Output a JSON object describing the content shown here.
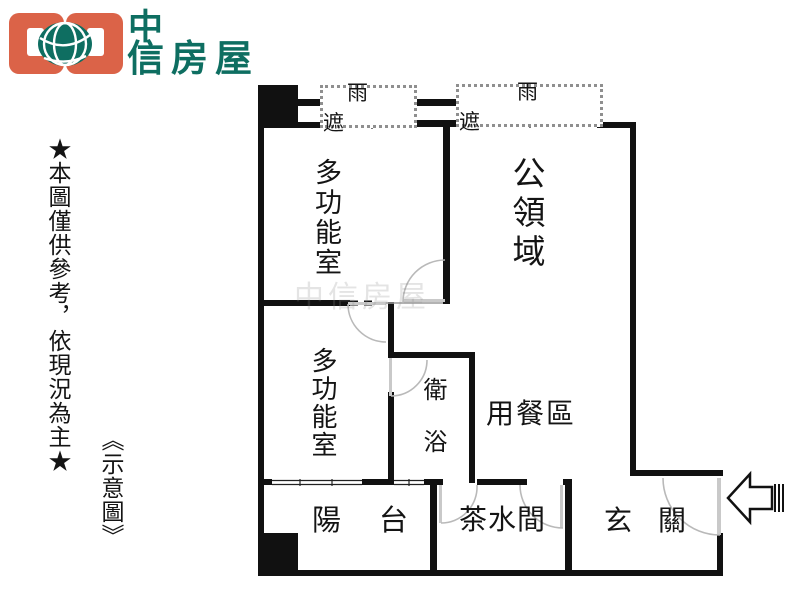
{
  "header": {
    "brand_char_top": "中",
    "brand_chars_bottom": "信房屋"
  },
  "side_notes": {
    "disclaimer": "★本圖僅供參考，依現況為主★",
    "caption": "《示意圖》"
  },
  "floorplan": {
    "labels": {
      "rain_shelter_1": "雨遮",
      "rain_shelter_2": "雨遮",
      "multi_function_room_1": "多功能室",
      "public_area": "公領域",
      "multi_function_room_2": "多功能室",
      "bathroom": "衛浴",
      "dining_area": "用餐區",
      "balcony": "陽台",
      "pantry": "茶水間",
      "entry": "玄關"
    },
    "watermark": "中信房屋",
    "colors": {
      "wall": "#111111",
      "door_line": "#b9b9b9",
      "brand_orange": "#db6348",
      "brand_teal": "#0e6e61"
    }
  }
}
